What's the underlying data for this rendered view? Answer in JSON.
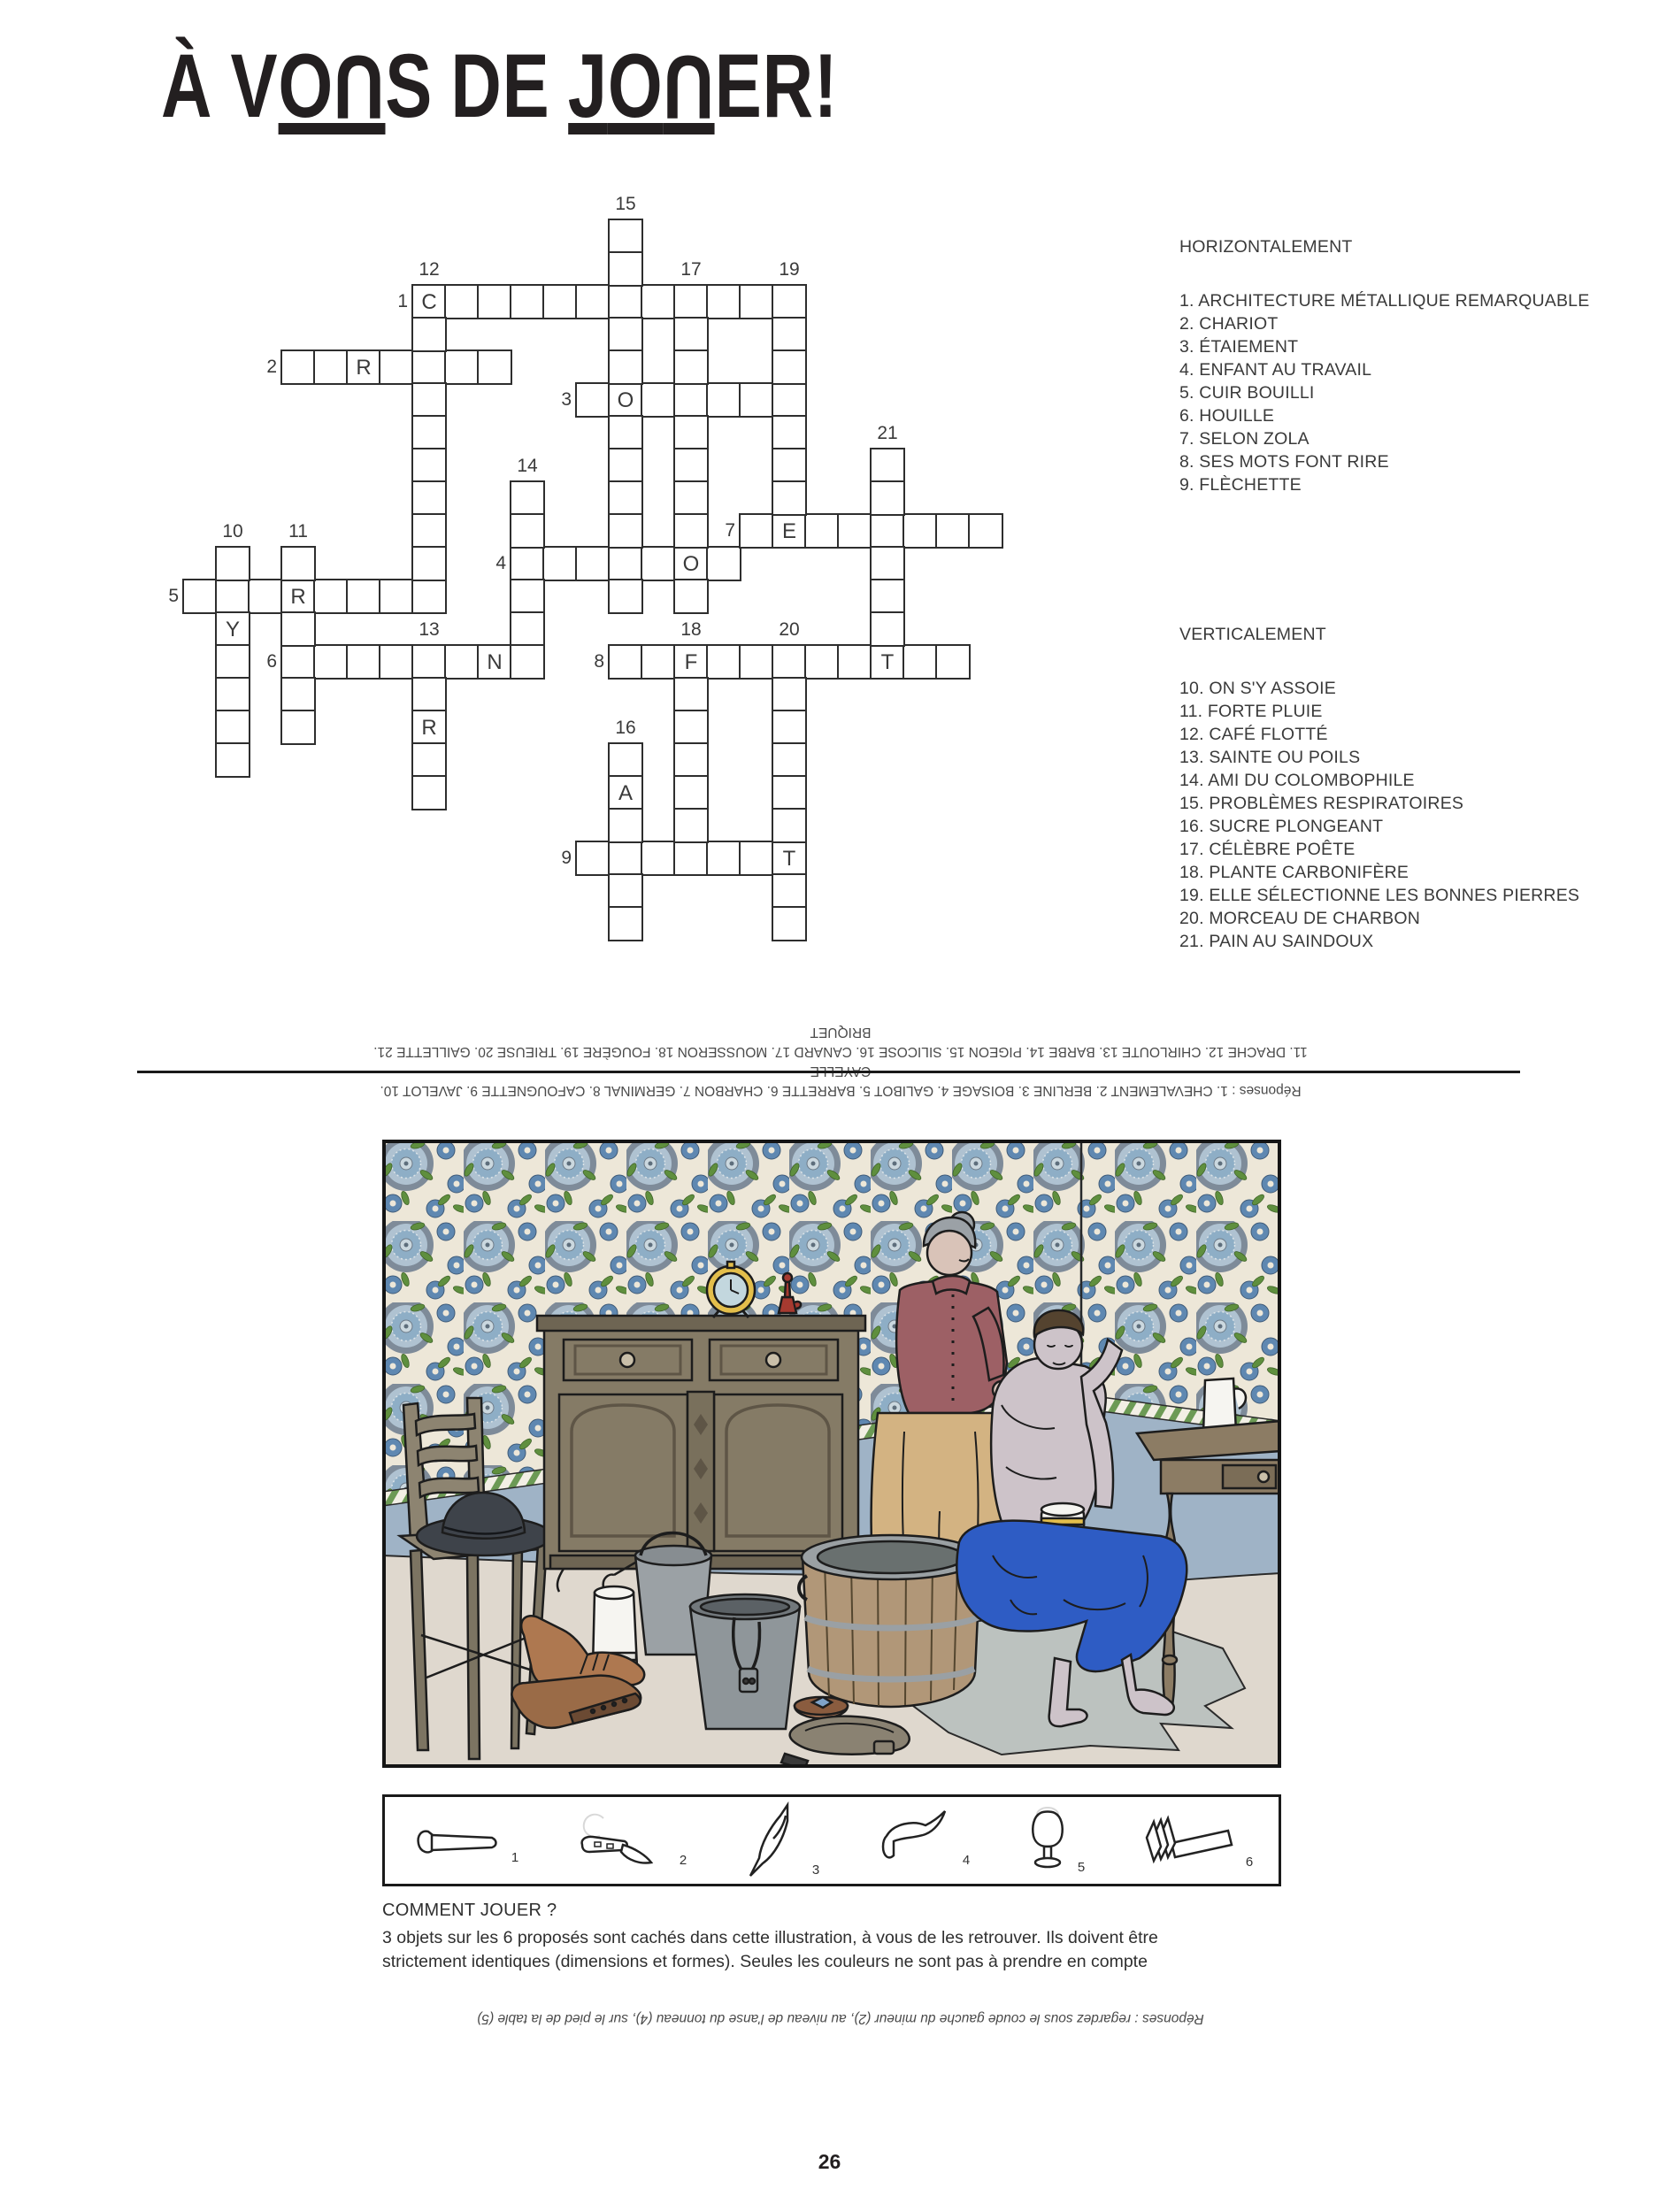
{
  "page": {
    "title": "À VOUS DE JOUER!",
    "page_number": "26"
  },
  "clues": {
    "across_heading": "HORIZONTALEMENT",
    "across": [
      "1. ARCHITECTURE MÉTALLIQUE REMARQUABLE",
      "2. CHARIOT",
      "3. ÉTAIEMENT",
      "4. ENFANT AU TRAVAIL",
      "5. CUIR BOUILLI",
      "6. HOUILLE",
      "7. SELON ZOLA",
      "8. SES MOTS FONT RIRE",
      "9. FLÈCHETTE"
    ],
    "down_heading": "VERTICALEMENT",
    "down": [
      "10. ON S'Y ASSOIE",
      "11. FORTE PLUIE",
      "12. CAFÉ FLOTTÉ",
      "13. SAINTE OU POILS",
      "14. AMI DU COLOMBOPHILE",
      "15. PROBLÈMES RESPIRATOIRES",
      "16. SUCRE PLONGEANT",
      "17. CÉLÈBRE POÊTE",
      "18. PLANTE CARBONIFÈRE",
      "19. ELLE SÉLECTIONNE LES BONNES PIERRES",
      "20. MORCEAU DE CHARBON",
      "21. PAIN AU SAINDOUX"
    ]
  },
  "crossword": {
    "cell_size": 37,
    "entries": [
      {
        "label": "1",
        "dir": "across",
        "col": 9,
        "row": 2,
        "len": 11
      },
      {
        "label": "2",
        "dir": "across",
        "col": 5,
        "row": 4,
        "len": 7
      },
      {
        "label": "3",
        "dir": "across",
        "col": 14,
        "row": 5,
        "len": 7
      },
      {
        "label": "4",
        "dir": "across",
        "col": 12,
        "row": 10,
        "len": 7
      },
      {
        "label": "5",
        "dir": "across",
        "col": 2,
        "row": 11,
        "len": 8
      },
      {
        "label": "6",
        "dir": "across",
        "col": 5,
        "row": 13,
        "len": 7
      },
      {
        "label": "7",
        "dir": "across",
        "col": 19,
        "row": 9,
        "len": 8
      },
      {
        "label": "8",
        "dir": "across",
        "col": 15,
        "row": 13,
        "len": 11
      },
      {
        "label": "9",
        "dir": "across",
        "col": 14,
        "row": 19,
        "len": 7
      },
      {
        "label": "10",
        "dir": "down",
        "col": 3,
        "row": 10,
        "len": 7
      },
      {
        "label": "11",
        "dir": "down",
        "col": 5,
        "row": 10,
        "len": 6
      },
      {
        "label": "12",
        "dir": "down",
        "col": 9,
        "row": 2,
        "len": 9
      },
      {
        "label": "13",
        "dir": "down",
        "col": 9,
        "row": 13,
        "len": 5
      },
      {
        "label": "14",
        "dir": "down",
        "col": 12,
        "row": 8,
        "len": 6
      },
      {
        "label": "15",
        "dir": "down",
        "col": 15,
        "row": 0,
        "len": 12
      },
      {
        "label": "16",
        "dir": "down",
        "col": 15,
        "row": 16,
        "len": 6
      },
      {
        "label": "17",
        "dir": "down",
        "col": 17,
        "row": 2,
        "len": 10
      },
      {
        "label": "18",
        "dir": "down",
        "col": 17,
        "row": 13,
        "len": 7
      },
      {
        "label": "19",
        "dir": "down",
        "col": 20,
        "row": 2,
        "len": 7
      },
      {
        "label": "20",
        "dir": "down",
        "col": 20,
        "row": 13,
        "len": 9
      },
      {
        "label": "21",
        "dir": "down",
        "col": 23,
        "row": 7,
        "len": 7
      }
    ],
    "prefills": [
      {
        "col": 9,
        "row": 2,
        "ch": "C"
      },
      {
        "col": 7,
        "row": 4,
        "ch": "R"
      },
      {
        "col": 15,
        "row": 5,
        "ch": "O"
      },
      {
        "col": 20,
        "row": 9,
        "ch": "E"
      },
      {
        "col": 17,
        "row": 10,
        "ch": "O"
      },
      {
        "col": 5,
        "row": 11,
        "ch": "R"
      },
      {
        "col": 3,
        "row": 12,
        "ch": "Y"
      },
      {
        "col": 11,
        "row": 13,
        "ch": "N"
      },
      {
        "col": 17,
        "row": 13,
        "ch": "F"
      },
      {
        "col": 23,
        "row": 13,
        "ch": "T"
      },
      {
        "col": 9,
        "row": 15,
        "ch": "R"
      },
      {
        "col": 15,
        "row": 17,
        "ch": "A"
      },
      {
        "col": 20,
        "row": 19,
        "ch": "T"
      }
    ]
  },
  "answers_top": {
    "line1": "Réponses : 1. CHEVALEMENT 2. BERLINE 3. BOISAGE 4. GALIBOT 5. BARRETTE 6. CHARBON 7. GERMINAL 8. CAFOUGNETTE 9. JAVELOT 10. CAYELLE",
    "line2": "11. DRACHE 12. CHIRLOUTE 13. BARBE 14. PIGEON 15. SILICOSE 16. CANARD 17. MOUSSERON 18. FOUGÈRE 19. TRIEUSE 20. GAILLETTE 21. BRIQUET"
  },
  "objects_strip": {
    "numbers": [
      "1",
      "2",
      "3",
      "4",
      "5",
      "6"
    ],
    "names": [
      "nail-pin",
      "pocket-knife",
      "bird",
      "flat-cap",
      "glass-lamp",
      "scrub-brush"
    ]
  },
  "how_to_play": {
    "heading": "COMMENT JOUER ?",
    "body1": "3 objets sur les 6 proposés sont cachés dans cette illustration, à vous de les retrouver. Ils doivent être",
    "body2": "strictement identiques (dimensions et formes). Seules les couleurs ne sont pas à prendre en compte"
  },
  "answers_bottom": "Réponses : regardez sous le coude gauche du mineur (2), au niveau de l'anse du tonneau (4), sur le pied de la table (5)",
  "illustration": {
    "colors": {
      "wallpaper_bg": "#EDE7D8",
      "medallion_ring": "#7E8B99",
      "medallion_inner": "#8EAEC6",
      "flower_blue": "#5F88B1",
      "leaf_green": "#5F8F3E",
      "wainscot_blue": "#9FB3C6",
      "floor": "#DFD8CE",
      "rug_grey": "#BCC2BF",
      "wood_cabinet": "#857B66",
      "wood_dark": "#6E6553",
      "blouse_rose": "#9D6065",
      "skirt_tan": "#D3B382",
      "skin": "#CDC3C9",
      "trousers_blue": "#2E5CC4",
      "tub_wood": "#B19778",
      "bucket_grey": "#9BA1A5",
      "boot_brown": "#AE7850",
      "hat_dark": "#3E434A",
      "clock_yellow": "#E3BE4B",
      "lamp_red": "#A63A30",
      "sponge_yellow": "#E6DD85"
    }
  }
}
